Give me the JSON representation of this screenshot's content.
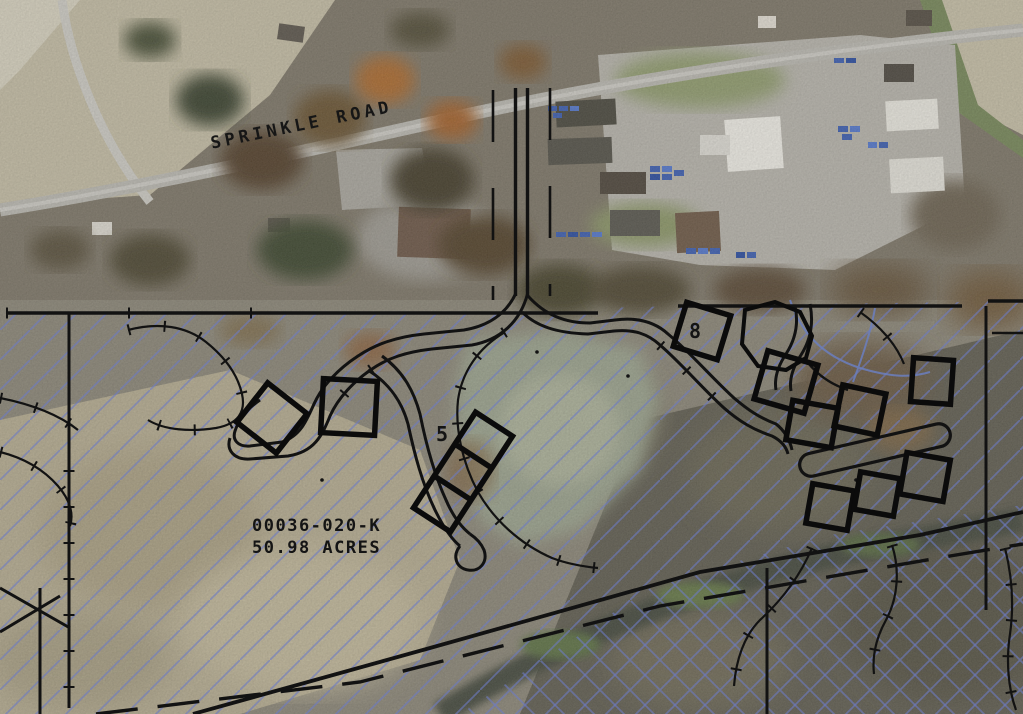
{
  "map": {
    "road_label": "SPRINKLE ROAD",
    "parcel": {
      "id": "00036-020-K",
      "acres_label": "50.98 ACRES"
    },
    "building_labels": [
      {
        "value": "5"
      },
      {
        "value": "8"
      }
    ],
    "legend_semantics": {
      "single_hatch": "parcel area hatch",
      "cross_hatch": "wetland cross-hatch",
      "bold_squares": "proposed building footprints"
    }
  },
  "colors": {
    "hatch_blue": "#6c7ac4",
    "linework_black": "#121212",
    "label_black": "#141414",
    "road_gray": "#b7b5ae",
    "field_tan": "#c0b9a2",
    "woods_gray": "#7d7668",
    "gravel_gray": "#b4b1a9",
    "boat_blue": "#3f5fae"
  }
}
